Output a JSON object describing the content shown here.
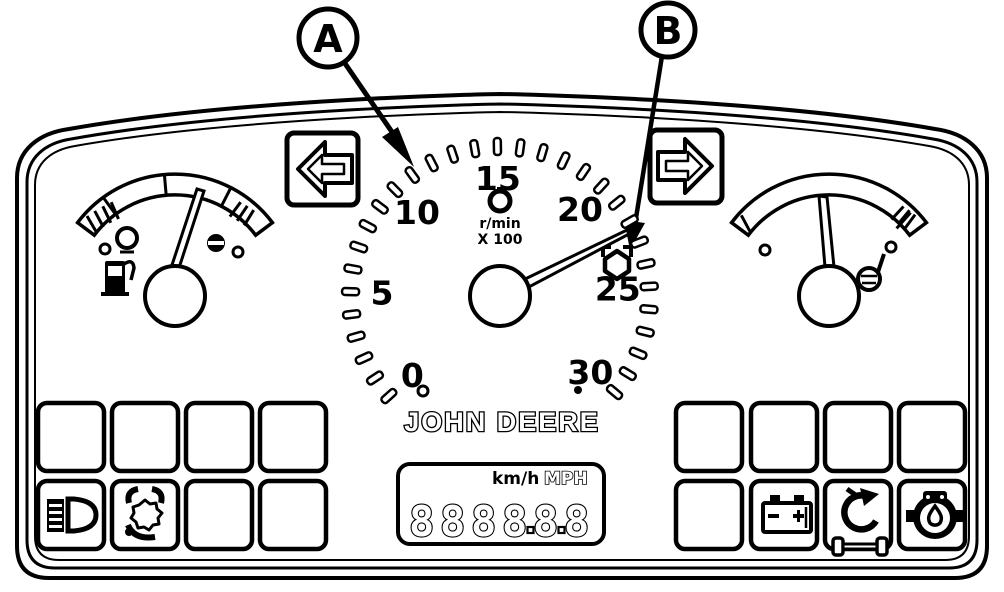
{
  "diagram_title": "Instrument panel line-art diagram",
  "colors": {
    "ink": "#000000",
    "paper": "#ffffff"
  },
  "callouts": {
    "a_label": "A",
    "b_label": "B",
    "a_points_to": "tachometer scale mark",
    "b_points_to": "PTO speed mark"
  },
  "tachometer": {
    "type": "gauge",
    "min": 0,
    "max": 30,
    "major_step": 5,
    "major_labels": [
      "0",
      "5",
      "10",
      "15",
      "20",
      "25",
      "30"
    ],
    "unit_line1": "r/min",
    "unit_line2": "X 100",
    "center_icon": "engine-rpm",
    "needle_value": 22.4,
    "pto_mark_value": 24
  },
  "brand_text": "John Deere",
  "lcd": {
    "digits": [
      "8",
      "8",
      "8",
      "8",
      "8",
      "8"
    ],
    "decimal_after": [
      3,
      4
    ],
    "unit_metric": "km/h",
    "unit_imperial": "MPH"
  },
  "turn_signals": {
    "left": "left-arrow",
    "right": "right-arrow"
  },
  "gauges": {
    "fuel": {
      "icon": "fuel-pump",
      "side": "left"
    },
    "temperature": {
      "icon": "coolant-temperature",
      "side": "right"
    }
  },
  "indicator_grids": {
    "left": {
      "rows": 2,
      "cols": 4,
      "icons": [
        "headlights",
        "differential-lock"
      ]
    },
    "right": {
      "rows": 2,
      "cols": 4,
      "icons": [
        "battery-charge",
        "mfwd-axle",
        "transmission-oil"
      ]
    }
  }
}
